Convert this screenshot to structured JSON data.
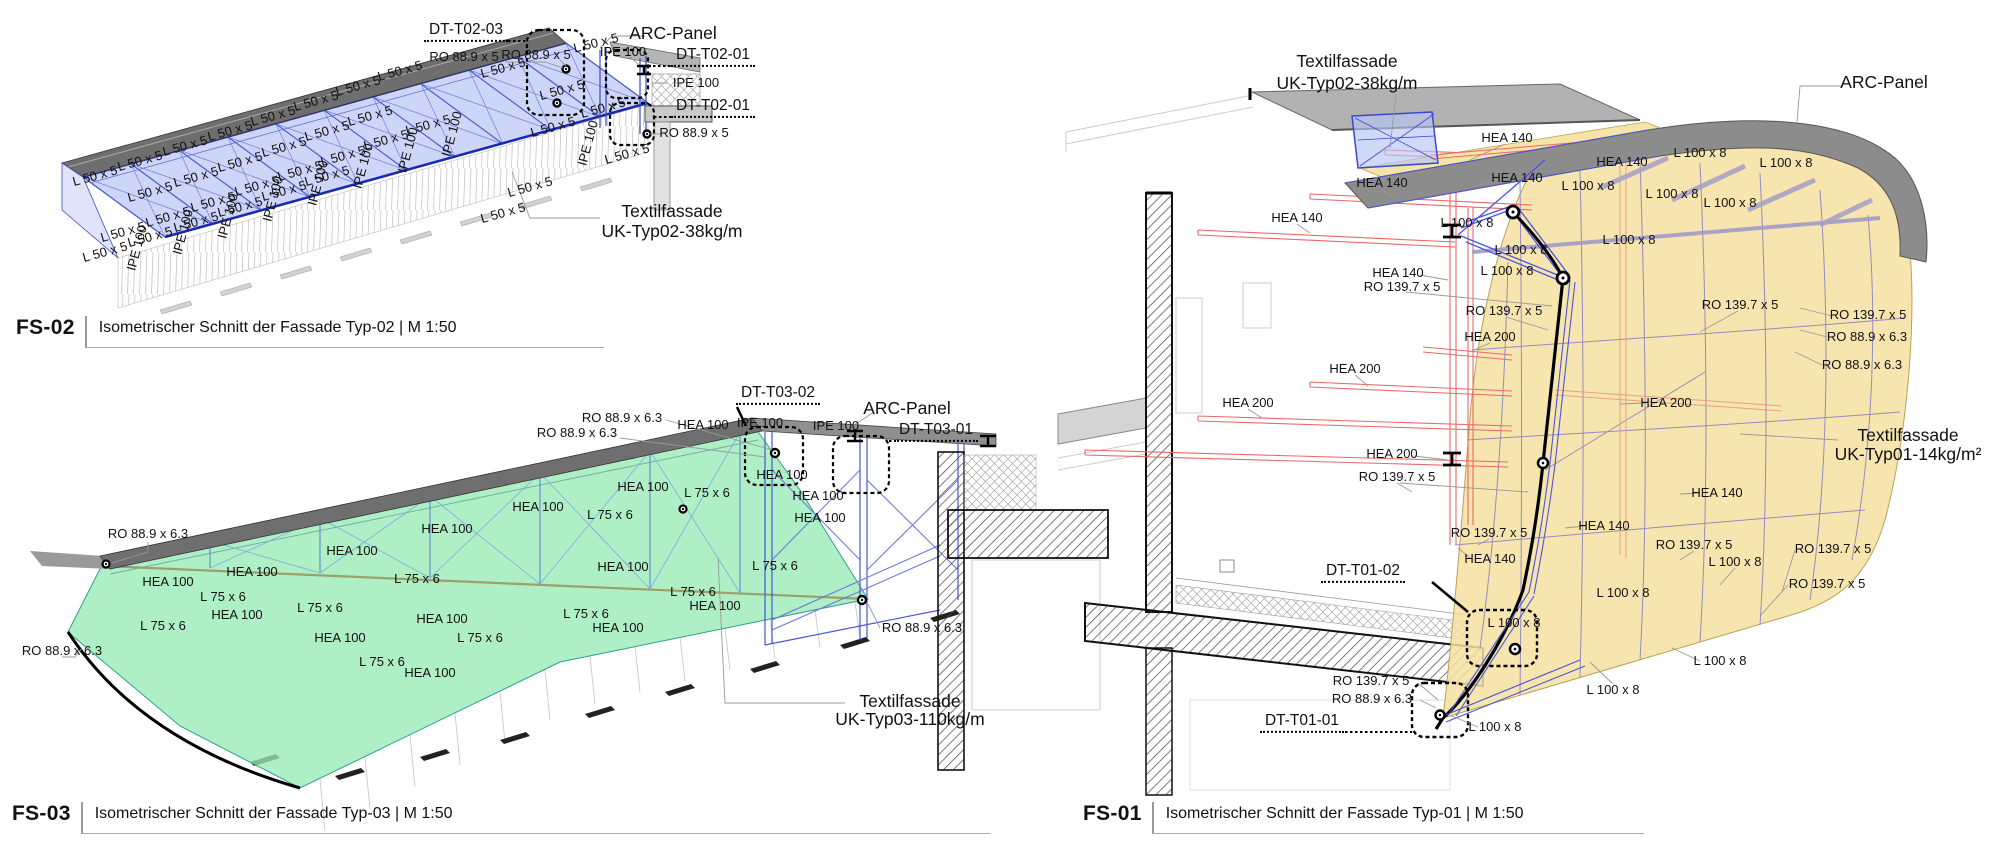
{
  "colors": {
    "membrane_typ02": "#aebcf4",
    "membrane_typ03": "#98ebb6",
    "membrane_typ01": "#f5e0a0",
    "steel_blue": "#3a48d0",
    "steel_red": "#e86a6a",
    "panel_gray": "#8c8c8c"
  },
  "panels": {
    "fs02": {
      "code": "FS-02",
      "caption": "Isometrischer Schnitt der Fassade Typ-02 | M 1:50",
      "labels": [
        [
          "L 50 x 5",
          95,
          176,
          -15.5,
          ""
        ],
        [
          "L 50 x 5",
          140,
          161,
          -15.5,
          ""
        ],
        [
          "L 50 x 5",
          185,
          146,
          -15.5,
          ""
        ],
        [
          "L 50 x 5",
          230,
          131,
          -15.5,
          ""
        ],
        [
          "L 50 x 5",
          273,
          116,
          -15.5,
          ""
        ],
        [
          "L 50 x 5",
          316,
          101,
          -15.5,
          ""
        ],
        [
          "L 50 x 5",
          358,
          86,
          -15.5,
          ""
        ],
        [
          "L 50 x 5",
          400,
          71,
          -15.5,
          ""
        ],
        [
          "L 50 x 5",
          150,
          192,
          -15.5,
          ""
        ],
        [
          "L 50 x 5",
          196,
          177,
          -15.5,
          ""
        ],
        [
          "L 50 x 5",
          240,
          162,
          -15.5,
          ""
        ],
        [
          "L 50 x 5",
          284,
          147,
          -15.5,
          ""
        ],
        [
          "L 50 x 5",
          327,
          131,
          -15.5,
          ""
        ],
        [
          "L 50 x 5",
          370,
          116,
          -15.5,
          ""
        ],
        [
          "L 50 x 5",
          123,
          232,
          -15.5,
          ""
        ],
        [
          "L 50 x 5",
          168,
          217,
          -15.5,
          ""
        ],
        [
          "L 50 x 5",
          213,
          202,
          -15.5,
          ""
        ],
        [
          "L 50 x 5",
          257,
          186,
          -15.5,
          ""
        ],
        [
          "L 50 x 5",
          300,
          171,
          -15.5,
          ""
        ],
        [
          "L 50 x 5",
          343,
          156,
          -15.5,
          ""
        ],
        [
          "L 50 x 5",
          386,
          140,
          -15.5,
          ""
        ],
        [
          "L 50 x 5",
          428,
          125,
          -15.5,
          ""
        ],
        [
          "L 50 x 5",
          105,
          252,
          -15.5,
          ""
        ],
        [
          "L 50 x 5",
          150,
          237,
          -15.5,
          ""
        ],
        [
          "L 50 x 5",
          196,
          222,
          -15.5,
          ""
        ],
        [
          "L 50 x 5",
          240,
          207,
          -15.5,
          ""
        ],
        [
          "L 50 x 5",
          284,
          191,
          -15.5,
          ""
        ],
        [
          "L 50 x 5",
          327,
          176,
          -15.5,
          ""
        ],
        [
          "L 50 x 5",
          596,
          43,
          -14,
          ""
        ],
        [
          "L 50 x 5",
          562,
          90,
          -15.5,
          ""
        ],
        [
          "L 50 x 5",
          603,
          108,
          -15.5,
          ""
        ],
        [
          "L 50 x 5",
          553,
          127,
          -15.5,
          ""
        ],
        [
          "L 50 x 5",
          627,
          154,
          -15.5,
          ""
        ],
        [
          "L 50 x 5",
          530,
          187,
          -15.5,
          ""
        ],
        [
          "L 50 x 5",
          503,
          213,
          -15.5,
          ""
        ],
        [
          "L 50 x 5",
          503,
          68,
          -15.5,
          ""
        ],
        [
          "IPE 100",
          137,
          248,
          -75,
          ""
        ],
        [
          "IPE 100",
          183,
          232,
          -75,
          ""
        ],
        [
          "IPE 100",
          228,
          216,
          -75,
          ""
        ],
        [
          "IPE 100",
          273,
          199,
          -75,
          ""
        ],
        [
          "IPE 100",
          318,
          183,
          -75,
          ""
        ],
        [
          "IPE 100",
          363,
          166,
          -75,
          ""
        ],
        [
          "IPE 100",
          408,
          150,
          -75,
          ""
        ],
        [
          "IPE 100",
          452,
          134,
          -75,
          ""
        ],
        [
          "IPE 100",
          588,
          143,
          -75,
          ""
        ],
        [
          "DT-T02-03",
          466,
          32,
          0,
          "dt"
        ],
        [
          "RO 88.9 x 5",
          464,
          57,
          0,
          ""
        ],
        [
          "RO 88.9 x 5",
          536,
          55,
          0,
          ""
        ],
        [
          "ARC-Panel",
          673,
          33,
          0,
          "big"
        ],
        [
          "IPE 100",
          623,
          52,
          0,
          ""
        ],
        [
          "DT-T02-01",
          713,
          57,
          0,
          "dt"
        ],
        [
          "IPE 100",
          696,
          83,
          0,
          ""
        ],
        [
          "DT-T02-01",
          713,
          108,
          0,
          "dt"
        ],
        [
          "RO 88.9 x 5",
          694,
          133,
          0,
          ""
        ],
        [
          "Textilfassade",
          672,
          211,
          0,
          "big"
        ],
        [
          "UK-Typ02-38kg/m",
          672,
          231,
          0,
          "big"
        ]
      ]
    },
    "fs03": {
      "code": "FS-03",
      "caption": "Isometrischer Schnitt der Fassade Typ-03 | M 1:50",
      "labels": [
        [
          "RO 88.9 x 6.3",
          148,
          534,
          0,
          ""
        ],
        [
          "RO 88.9 x 6.3",
          62,
          651,
          0,
          ""
        ],
        [
          "RO 88.9 x 6.3",
          622,
          418,
          0,
          ""
        ],
        [
          "RO 88.9 x 6.3",
          577,
          433,
          0,
          ""
        ],
        [
          "RO 88.9 x 6.3",
          922,
          628,
          0,
          ""
        ],
        [
          "HEA 100",
          168,
          582,
          0,
          ""
        ],
        [
          "HEA 100",
          252,
          572,
          0,
          ""
        ],
        [
          "HEA 100",
          352,
          551,
          0,
          ""
        ],
        [
          "HEA 100",
          447,
          529,
          0,
          ""
        ],
        [
          "HEA 100",
          538,
          507,
          0,
          ""
        ],
        [
          "HEA 100",
          643,
          487,
          0,
          ""
        ],
        [
          "HEA 100",
          237,
          615,
          0,
          ""
        ],
        [
          "HEA 100",
          340,
          638,
          0,
          ""
        ],
        [
          "HEA 100",
          442,
          619,
          0,
          ""
        ],
        [
          "HEA 100",
          430,
          673,
          0,
          ""
        ],
        [
          "HEA 100",
          623,
          567,
          0,
          ""
        ],
        [
          "HEA 100",
          715,
          606,
          0,
          ""
        ],
        [
          "HEA 100",
          618,
          628,
          0,
          ""
        ],
        [
          "HEA 100",
          703,
          425,
          0,
          ""
        ],
        [
          "HEA 100",
          782,
          475,
          0,
          ""
        ],
        [
          "HEA 100",
          818,
          496,
          0,
          ""
        ],
        [
          "HEA 100",
          820,
          518,
          0,
          ""
        ],
        [
          "L 75 x 6",
          223,
          597,
          0,
          ""
        ],
        [
          "L 75 x 6",
          163,
          626,
          0,
          ""
        ],
        [
          "L 75 x 6",
          320,
          608,
          0,
          ""
        ],
        [
          "L 75 x 6",
          417,
          579,
          0,
          ""
        ],
        [
          "L 75 x 6",
          382,
          662,
          0,
          ""
        ],
        [
          "L 75 x 6",
          480,
          638,
          0,
          ""
        ],
        [
          "L 75 x 6",
          707,
          493,
          0,
          ""
        ],
        [
          "L 75 x 6",
          610,
          515,
          0,
          ""
        ],
        [
          "L 75 x 6",
          775,
          566,
          0,
          ""
        ],
        [
          "L 75 x 6",
          693,
          592,
          0,
          ""
        ],
        [
          "L 75 x 6",
          586,
          614,
          0,
          ""
        ],
        [
          "IPE 100",
          760,
          423,
          0,
          ""
        ],
        [
          "IPE 100",
          836,
          426,
          0,
          ""
        ],
        [
          "DT-T03-02",
          778,
          395,
          0,
          "dt"
        ],
        [
          "DT-T03-01",
          936,
          432,
          0,
          "dt"
        ],
        [
          "ARC-Panel",
          907,
          408,
          0,
          "big"
        ],
        [
          "Textilfassade",
          910,
          701,
          0,
          "big"
        ],
        [
          "UK-Typ03-110kg/m",
          910,
          719,
          0,
          "big"
        ]
      ]
    },
    "fs01": {
      "code": "FS-01",
      "caption": "Isometrischer Schnitt der Fassade Typ-01 | M 1:50",
      "labels": [
        [
          "Textilfassade",
          1347,
          61,
          0,
          "big"
        ],
        [
          "UK-Typ02-38kg/m",
          1347,
          83,
          0,
          "big"
        ],
        [
          "ARC-Panel",
          1884,
          82,
          0,
          "big"
        ],
        [
          "HEA 140",
          1507,
          138,
          0,
          ""
        ],
        [
          "HEA 140",
          1517,
          178,
          0,
          ""
        ],
        [
          "HEA 140",
          1382,
          183,
          0,
          ""
        ],
        [
          "HEA 140",
          1297,
          218,
          0,
          ""
        ],
        [
          "HEA 140",
          1398,
          273,
          0,
          ""
        ],
        [
          "HEA 140",
          1622,
          162,
          0,
          ""
        ],
        [
          "HEA 140",
          1717,
          493,
          0,
          ""
        ],
        [
          "HEA 140",
          1604,
          526,
          0,
          ""
        ],
        [
          "HEA 140",
          1490,
          559,
          0,
          ""
        ],
        [
          "HEA 200",
          1248,
          403,
          0,
          ""
        ],
        [
          "HEA 200",
          1355,
          369,
          0,
          ""
        ],
        [
          "HEA 200",
          1490,
          337,
          0,
          ""
        ],
        [
          "HEA 200",
          1392,
          454,
          0,
          ""
        ],
        [
          "HEA 200",
          1666,
          403,
          0,
          ""
        ],
        [
          "L 100 x 8",
          1467,
          223,
          0,
          ""
        ],
        [
          "L 100 x 8",
          1521,
          250,
          0,
          ""
        ],
        [
          "L 100 x 8",
          1507,
          271,
          0,
          ""
        ],
        [
          "L 100 x 8",
          1588,
          186,
          0,
          ""
        ],
        [
          "L 100 x 8",
          1672,
          194,
          0,
          ""
        ],
        [
          "L 100 x 8",
          1730,
          203,
          0,
          ""
        ],
        [
          "L 100 x 8",
          1700,
          153,
          0,
          ""
        ],
        [
          "L 100 x 8",
          1786,
          163,
          0,
          ""
        ],
        [
          "L 100 x 8",
          1629,
          240,
          0,
          ""
        ],
        [
          "L 100 x 8",
          1735,
          562,
          0,
          ""
        ],
        [
          "L 100 x 8",
          1623,
          593,
          0,
          ""
        ],
        [
          "L 100 x 8",
          1514,
          623,
          0,
          ""
        ],
        [
          "L 100 x 8",
          1720,
          661,
          0,
          ""
        ],
        [
          "L 100 x 8",
          1613,
          690,
          0,
          ""
        ],
        [
          "L 100 x 8",
          1495,
          727,
          0,
          ""
        ],
        [
          "RO 139.7 x 5",
          1402,
          287,
          0,
          ""
        ],
        [
          "RO 139.7 x 5",
          1504,
          311,
          0,
          ""
        ],
        [
          "RO 139.7 x 5",
          1740,
          305,
          0,
          ""
        ],
        [
          "RO 139.7 x 5",
          1868,
          315,
          0,
          ""
        ],
        [
          "RO 139.7 x 5",
          1397,
          477,
          0,
          ""
        ],
        [
          "RO 139.7 x 5",
          1489,
          533,
          0,
          ""
        ],
        [
          "RO 139.7 x 5",
          1694,
          545,
          0,
          ""
        ],
        [
          "RO 139.7 x 5",
          1833,
          549,
          0,
          ""
        ],
        [
          "RO 139.7 x 5",
          1827,
          584,
          0,
          ""
        ],
        [
          "RO 139.7 x 5",
          1371,
          681,
          0,
          ""
        ],
        [
          "RO 88.9 x 6.3",
          1867,
          337,
          0,
          ""
        ],
        [
          "RO 88.9 x 6.3",
          1862,
          365,
          0,
          ""
        ],
        [
          "RO 88.9 x 6.3",
          1372,
          699,
          0,
          ""
        ],
        [
          "DT-T01-02",
          1363,
          573,
          0,
          "dt"
        ],
        [
          "DT-T01-01",
          1302,
          723,
          0,
          "dt"
        ],
        [
          "Textilfassade",
          1908,
          435,
          0,
          "big"
        ],
        [
          "UK-Typ01-14kg/m²",
          1908,
          454,
          0,
          "big"
        ]
      ]
    }
  }
}
